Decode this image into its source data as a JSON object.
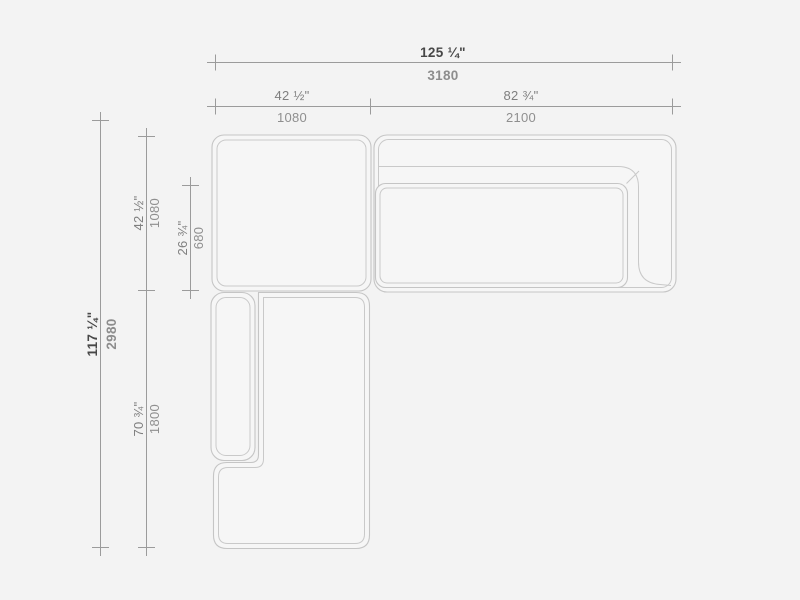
{
  "drawing": {
    "title": "sectional-sofa-top-view-dimension-drawing",
    "units": [
      "inches",
      "millimeters"
    ]
  },
  "colors": {
    "background": "#f3f3f3",
    "sofa_outline": "#c5c5c5",
    "sofa_fill": "#f6f6f6",
    "dimension_line": "#9b9b9b",
    "overall_inch_text": "#474747",
    "overall_mm_text": "#8d8d8d",
    "module_inch_text": "#7f7f7f",
    "module_mm_text": "#8f8f8f"
  },
  "dimensions": {
    "top_overall": {
      "inches": "125 ¼\"",
      "mm": "3180"
    },
    "top_left_module": {
      "inches": "42 ½\"",
      "mm": "1080"
    },
    "top_right_module": {
      "inches": "82 ¾\"",
      "mm": "2100"
    },
    "side_overall": {
      "inches": "117 ¼\"",
      "mm": "2980"
    },
    "side_corner_module": {
      "inches": "42 ½\"",
      "mm": "1080"
    },
    "side_seat_depth": {
      "inches": "26 ¾\"",
      "mm": "680"
    },
    "side_chaise_module": {
      "inches": "70 ¾\"",
      "mm": "1800"
    }
  }
}
